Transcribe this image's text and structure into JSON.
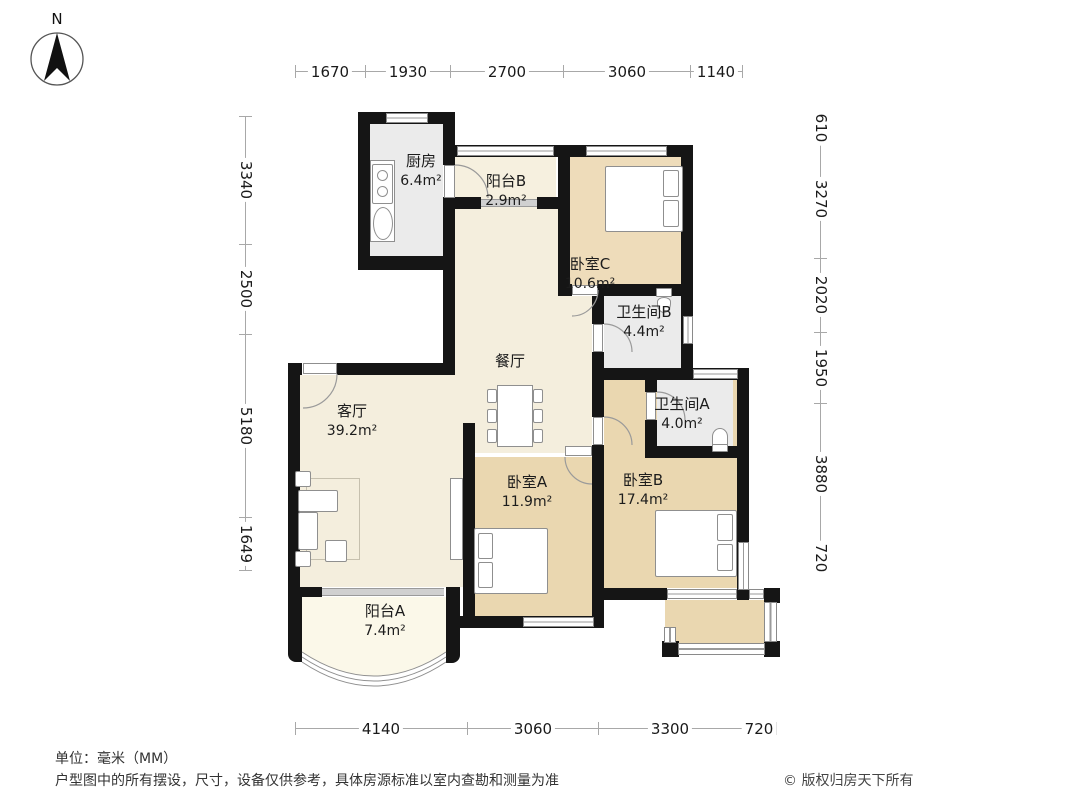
{
  "compass": {
    "label": "N"
  },
  "rooms": [
    {
      "id": "kitchen",
      "name": "厨房",
      "area": "6.4m²"
    },
    {
      "id": "balcony-b",
      "name": "阳台B",
      "area": "2.9m²"
    },
    {
      "id": "bedroom-c",
      "name": "卧室C",
      "area": "10.6m²"
    },
    {
      "id": "bath-b",
      "name": "卫生间B",
      "area": "4.4m²"
    },
    {
      "id": "bath-a",
      "name": "卫生间A",
      "area": "4.0m²"
    },
    {
      "id": "dining",
      "name": "餐厅",
      "area": ""
    },
    {
      "id": "living",
      "name": "客厅",
      "area": "39.2m²"
    },
    {
      "id": "bedroom-a",
      "name": "卧室A",
      "area": "11.9m²"
    },
    {
      "id": "bedroom-b",
      "name": "卧室B",
      "area": "17.4m²"
    },
    {
      "id": "balcony-a",
      "name": "阳台A",
      "area": "7.4m²"
    }
  ],
  "dims": {
    "top": [
      "1670",
      "1930",
      "2700",
      "3060",
      "1140"
    ],
    "bottom": [
      "4140",
      "3060",
      "3300",
      "720"
    ],
    "left": [
      "3340",
      "2500",
      "5180",
      "1649"
    ],
    "right": [
      "610",
      "3270",
      "2020",
      "1950",
      "3880",
      "720"
    ]
  },
  "footer": {
    "unit": "单位：毫米（MM）",
    "disclaimer": "户型图中的所有摆设，尺寸，设备仅供参考，具体房源标准以室内查勘和测量为准",
    "copyright": "© 版权归房天下所有"
  },
  "colors": {
    "wall": "#151515",
    "bedroom_floor": "#ead7b0",
    "living_floor": "#f4eedd",
    "balcony_floor": "#fbf8e9",
    "wet_floor": "#ebebeb",
    "dim_line": "#a8a8a8"
  }
}
